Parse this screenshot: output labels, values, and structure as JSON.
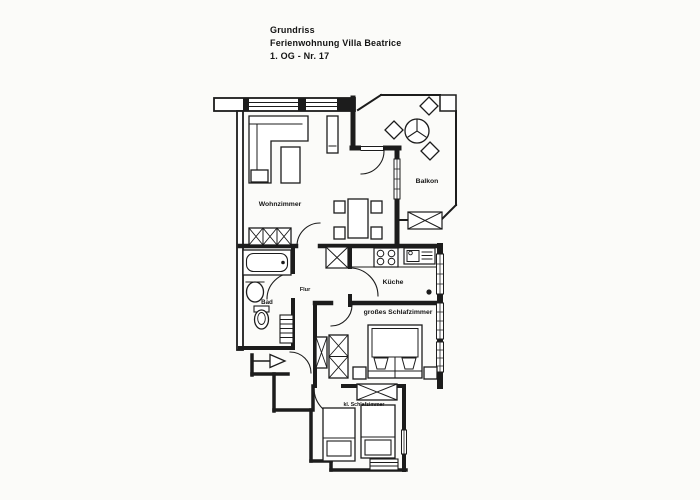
{
  "colors": {
    "paper": "#fbfbf9",
    "ink": "#1c1c1c"
  },
  "title": {
    "line1": "Grundriss",
    "line2": "Ferienwohnung Villa Beatrice",
    "line3": "1. OG - Nr. 17"
  },
  "rooms": {
    "living": {
      "label": "Wohnzimmer"
    },
    "balcony": {
      "label": "Balkon"
    },
    "kitchen": {
      "label": "Küche"
    },
    "hall": {
      "label": "Flur"
    },
    "bath": {
      "label": "Bad"
    },
    "bedroom_large": {
      "label": "großes Schlafzimmer"
    },
    "bedroom_small": {
      "label": "kl. Schlafzimmer"
    }
  }
}
